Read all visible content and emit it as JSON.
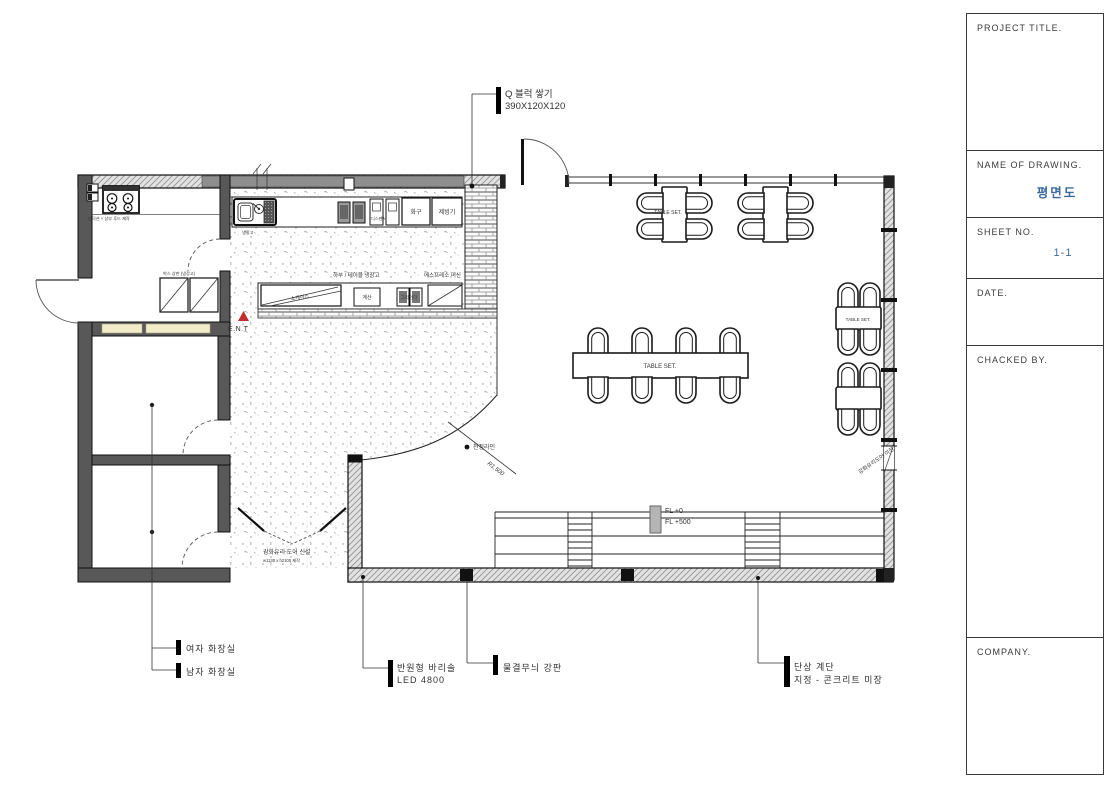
{
  "title_block": {
    "project_title_label": "PROJECT TITLE.",
    "name_of_drawing_label": "NAME OF DRAWING.",
    "drawing_name": "평면도",
    "sheet_no_label": "SHEET NO.",
    "sheet_no": "1-1",
    "date_label": "DATE.",
    "checked_by_label": "CHACKED BY.",
    "company_label": "COMPANY.",
    "accent_color": "#3d6a9e"
  },
  "plan": {
    "annotations": {
      "block_note_line1": "Q 블럭 쌓기",
      "block_note_line2": "390X120X120",
      "ceiling_line": "천정라인",
      "ceiling_radius": "R1,500",
      "ent_marker": "E.N.T",
      "fl_zero": "FL +0",
      "fl_500": "FL +500",
      "door_new_line1": "강화유리 도어 신설",
      "door_new_line2": "w1130 x h2100 제작",
      "door_relocated": "강화유리도어 이전",
      "induction_note": "인덕션 + 상부 후드 제작",
      "fridge_note": "박스 상판 (냉장고)",
      "women_restroom": "여자 화장실",
      "men_restroom": "남자 화장실",
      "barrisol_line1": "반원형 바리솔",
      "barrisol_line2": "LED 4800",
      "wave_steel_plate": "물결무늬 강판",
      "stage_line1": "단상 계단",
      "stage_line2": "지정 - 콘크리트 미장"
    },
    "equipment": {
      "sink_note": "냉장고",
      "dispenser": "디스펜서",
      "burner": "화구",
      "ice_maker": "제빙기",
      "under_counter_fridge": "하부 / 테이블 냉장고",
      "espresso_machine": "에스프레소 머신",
      "showcase": "쇼케이스",
      "register": "계산",
      "grinder": "그라인더",
      "table_set": "TABLE SET."
    }
  }
}
